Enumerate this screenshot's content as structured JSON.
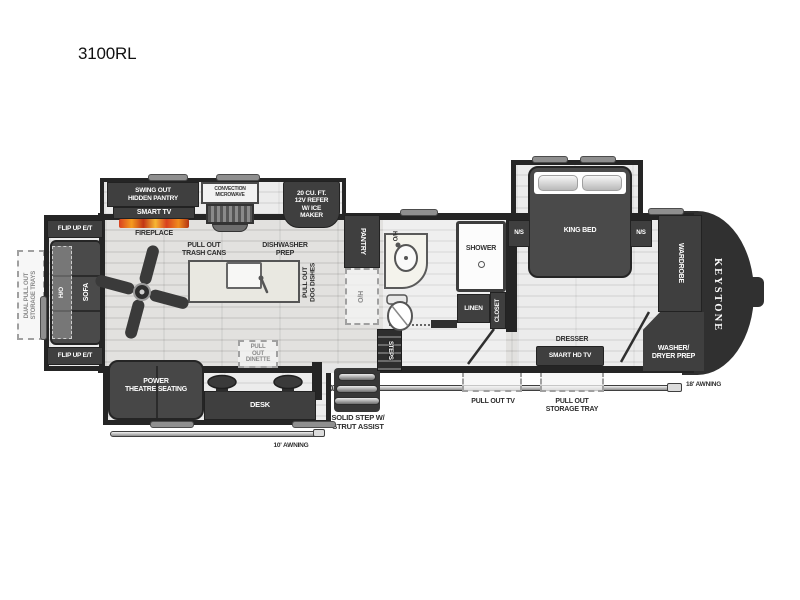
{
  "title": "3100RL",
  "brand": "KEYSTONE",
  "colors": {
    "wall": "#252525",
    "furniture_dark": "#3f3f3f",
    "floor_light": "#e2e1df",
    "flame_orange": "#f08c1e",
    "flame_red": "#d8401f",
    "label_dark": "#2e2e2e",
    "label_white": "#ffffff"
  },
  "labels": {
    "hidden_pantry": "SWING OUT\nHIDDEN PANTRY",
    "smart_tv": "SMART TV",
    "fireplace": "FIREPLACE",
    "microwave": "CONVECTION\nMICROWAVE",
    "refrigerator": "20 CU. FT.\n12V REFER\nW/ ICE\nMAKER",
    "pantry": "PANTRY",
    "pantry_overhead": "O/H",
    "trash_cans": "PULL OUT\nTRASH CANS",
    "dishwasher_prep": "DISHWASHER\nPREP",
    "dog_dishes": "PULL OUT\nDOG DISHES",
    "bath_overhead": "H/O",
    "shower": "SHOWER",
    "linen": "LINEN",
    "closet": "CLOSET",
    "steps": "STEPS",
    "nightstand_left": "N/S",
    "nightstand_right": "N/S",
    "king_bed": "KING BED",
    "wardrobe": "WARDROBE",
    "washer_dryer": "WASHER/\nDRYER PREP",
    "dresser": "DRESSER",
    "smart_hd_tv": "SMART HD TV",
    "flip_up_et_top": "FLIP UP E/T",
    "flip_up_et_bottom": "FLIP UP E/T",
    "sofa": "SOFA",
    "sofa_overhead": "H/O",
    "storage_trays_rear": "DUAL PULL OUT\nSTORAGE TRAYS",
    "theatre_seating": "POWER\nTHEATRE SEATING",
    "desk": "DESK",
    "dinette": "PULL\nOUT\nDINETTE",
    "solid_step": "SOLID STEP W/\nSTRUT ASSIST",
    "awning_10": "10' AWNING",
    "awning_18": "18' AWNING",
    "pull_out_tv": "PULL OUT TV",
    "pull_out_storage_tray": "PULL OUT\nSTORAGE TRAY"
  }
}
